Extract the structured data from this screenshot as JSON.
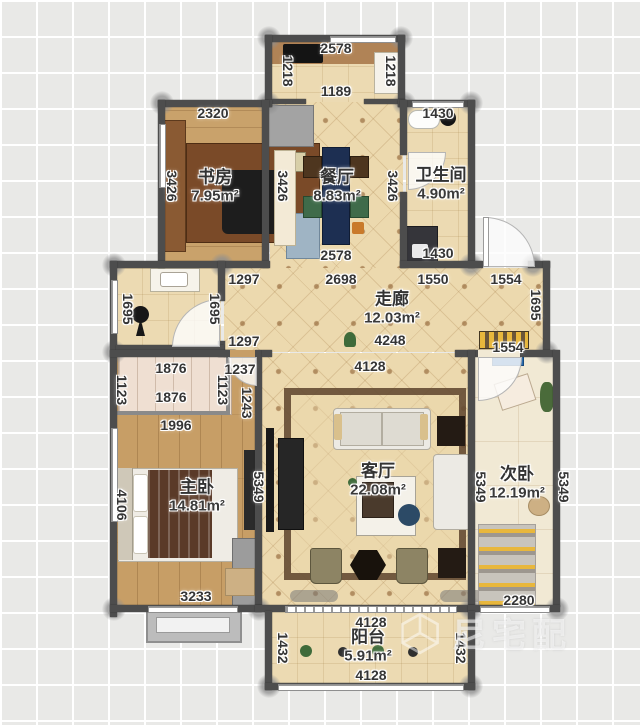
{
  "rooms": {
    "study": {
      "name": "书房",
      "area": "7.95m²"
    },
    "dining": {
      "name": "餐厅",
      "area": "8.83m²"
    },
    "bath": {
      "name": "卫生间",
      "area": "4.90m²"
    },
    "corridor": {
      "name": "走廊",
      "area": "12.03m²"
    },
    "master": {
      "name": "主卧",
      "area": "14.81m²"
    },
    "living": {
      "name": "客厅",
      "area": "22.08m²"
    },
    "second": {
      "name": "次卧",
      "area": "12.19m²"
    },
    "balcony": {
      "name": "阳台",
      "area": "5.91m²"
    }
  },
  "dims": {
    "ext_top": "2578",
    "ext_left": "1218",
    "ext_right": "1218",
    "ext_inner": "1189",
    "study_top": "2320",
    "study_left": "3426",
    "dining_left": "3426",
    "dining_right": "3426",
    "dining_bottom": "2578",
    "bath_top": "1430",
    "bath_bottom": "1430",
    "cor_top_left": "1297",
    "cor_top_mid": "2698",
    "cor_top_r1": "1550",
    "cor_top_r2": "1554",
    "cor_bot_left": "1297",
    "cor_bot_mid": "4248",
    "cor_bot_right": "1554",
    "wash_left": "1695",
    "wash_right": "1695",
    "cor_right": "1695",
    "alcove_top": "1876",
    "alcove_bottom": "1876",
    "alcove_left": "1123",
    "alcove_right": "1123",
    "mb_1996": "1996",
    "mb_1237": "1237",
    "mb_1243": "1243",
    "mb_left": "4106",
    "mb_bottom": "3233",
    "lr_top": "4128",
    "lr_left": "5349",
    "sb_left": "5349",
    "sb_right": "5349",
    "sb_bottom": "2280",
    "bal_top": "4128",
    "bal_bottom": "4128",
    "bal_left": "1432",
    "bal_right": "1432"
  },
  "watermark": {
    "text": "尼宅配"
  },
  "colors": {
    "wall": "#4d4d4d",
    "floor_quilt": "#ecd9ae",
    "floor_wood": "#c79e66",
    "accent_navy": "#223a5e",
    "accent_olive": "#8d8464",
    "accent_yellow": "#e8b73c"
  }
}
